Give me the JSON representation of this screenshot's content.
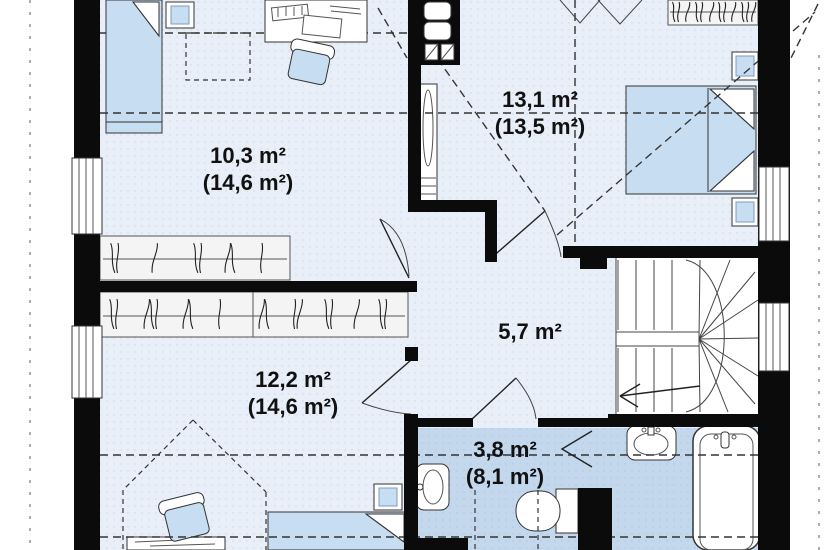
{
  "floorplan": {
    "title": "first-floor-plan",
    "rooms": [
      {
        "name": "bedroom-top-left",
        "area_label": "10,3 m²",
        "area_total_label": "(14,6 m²)"
      },
      {
        "name": "bedroom-top-right",
        "area_label": "13,1 m²",
        "area_total_label": "(13,5 m²)"
      },
      {
        "name": "hall",
        "area_label": "5,7 m²",
        "area_total_label": ""
      },
      {
        "name": "bedroom-bottom-left",
        "area_label": "12,2 m²",
        "area_total_label": "(14,6 m²)"
      },
      {
        "name": "bathroom",
        "area_label": "3,8 m²",
        "area_total_label": "(8,1 m²)"
      }
    ],
    "colors": {
      "wall": "#0b0b0b",
      "floor": "#e9eff8",
      "bathroom_floor": "#c3d8ed",
      "furniture": "#c7ddf1",
      "line": "#333333"
    }
  }
}
